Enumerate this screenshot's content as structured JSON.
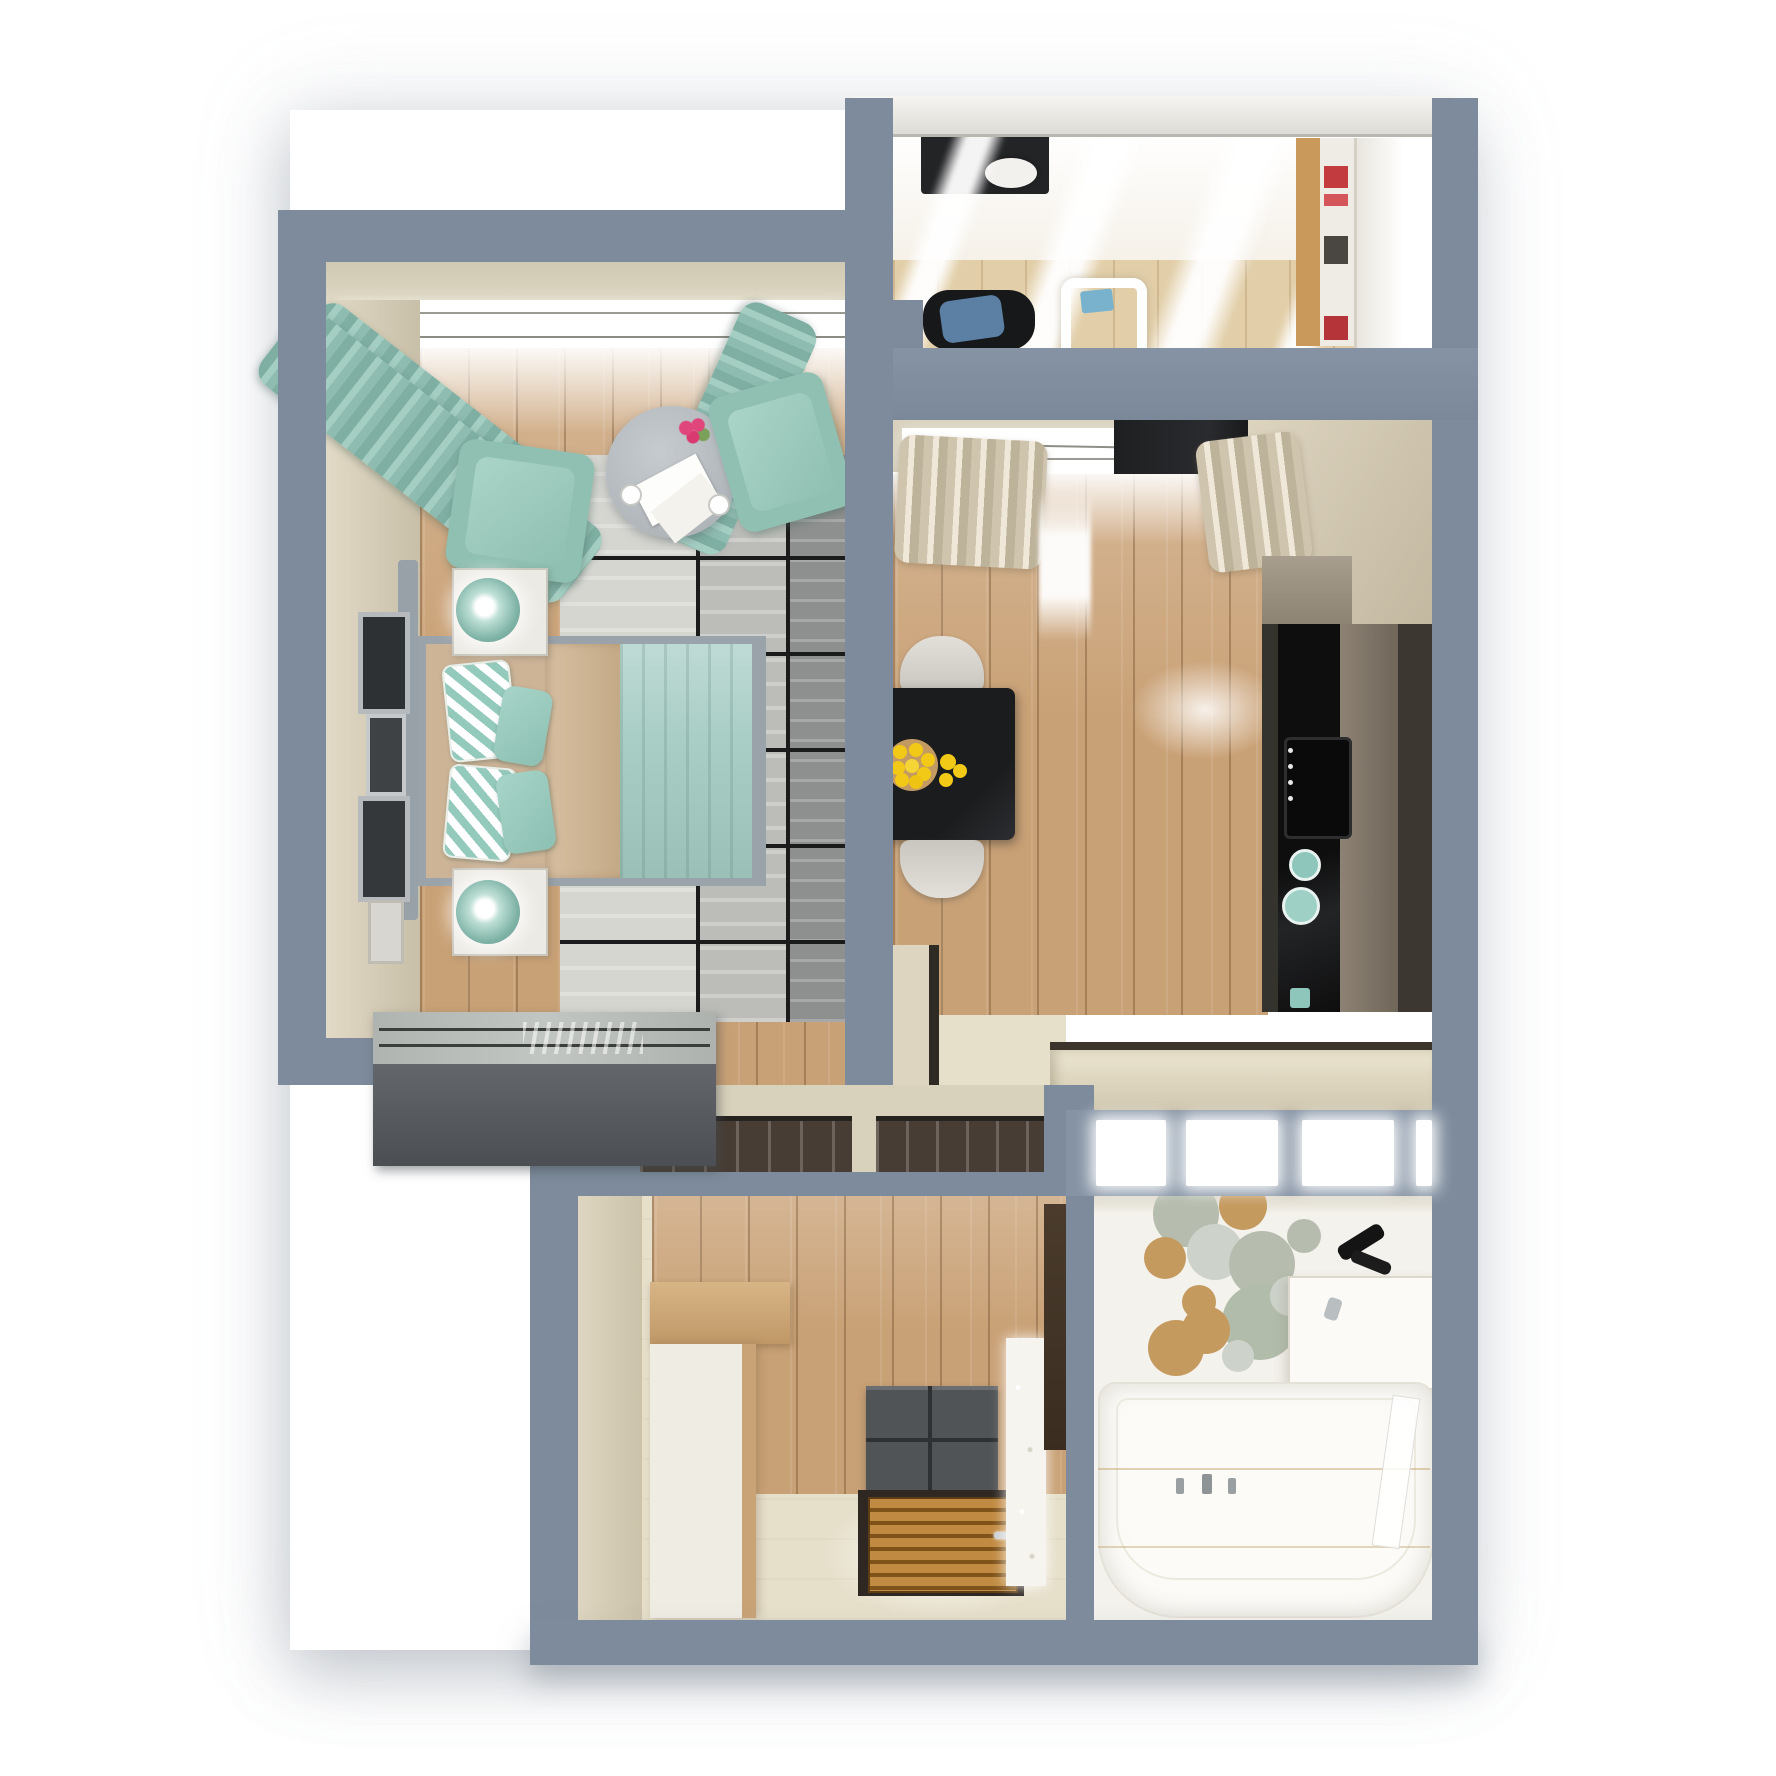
{
  "meta": {
    "title": "3D top-down floor plan render of a one-bedroom apartment",
    "style": "photorealistic architectural visualization, no on-screen text"
  },
  "palette": {
    "wall": "#7d8b9c",
    "wallLight": "#8593a4",
    "roof": "#e9e8e4",
    "beige": "#d9d1bc",
    "cream": "#e6dfca",
    "wood": "#c9a176",
    "teal": "#8fbcb0",
    "tealLight": "#a9d2c7",
    "duvet": "#cdb497",
    "bedframe": "#9aa2aa",
    "black": "#17181a",
    "charcoal": "#515456",
    "mat": "#473d34",
    "doorwood": "#b87d36",
    "lemon": "#f2c917",
    "rugDark": "#8e908f",
    "sage": "#b6bdae",
    "tan": "#c59a5f",
    "stone": "#cdd2ca",
    "blue": "#5b80a4",
    "red": "#c23b3f"
  },
  "rooms": {
    "bedroom": {
      "label": "bedroom",
      "furniture": [
        "double bed",
        "two nightstands with teal lamps",
        "two teal armchairs",
        "round coffee table with flowers",
        "teal curtains",
        "gray grid rug",
        "dark gray wardrobe",
        "wall frames"
      ]
    },
    "kitchen": {
      "label": "kitchen-living room",
      "furniture": [
        "black dining table",
        "bowl of lemons",
        "two gray chairs",
        "beige curtains",
        "dark kitchen units",
        "black cooktop",
        "teal dishes",
        "bottom counter"
      ]
    },
    "balcony": {
      "label": "balcony office",
      "furniture": [
        "dark desk",
        "office chair with blue cushion",
        "white chair",
        "shelving with red books",
        "white wardrobe"
      ]
    },
    "hallway": {
      "label": "hallway",
      "furniture": [
        "wood-top sideboard",
        "charcoal shoe dresser",
        "entrance door (top view)",
        "sparkling curtain strip",
        "dark wall panel"
      ]
    },
    "bathroom": {
      "label": "bathroom",
      "furniture": [
        "bathtub with faucets",
        "washbasin counter",
        "black shower fixture",
        "circle wall decor"
      ]
    }
  },
  "bathroom_decor_circles": [
    {
      "x": 1186,
      "y": 1214,
      "r": 33,
      "c": "#b6bdae"
    },
    {
      "x": 1243,
      "y": 1206,
      "r": 24,
      "c": "#c59a5f"
    },
    {
      "x": 1165,
      "y": 1258,
      "r": 21,
      "c": "#c59a5f"
    },
    {
      "x": 1215,
      "y": 1252,
      "r": 28,
      "c": "#cdd2ca"
    },
    {
      "x": 1262,
      "y": 1264,
      "r": 33,
      "c": "#b6bdae"
    },
    {
      "x": 1199,
      "y": 1302,
      "r": 17,
      "c": "#c59a5f"
    },
    {
      "x": 1260,
      "y": 1322,
      "r": 38,
      "c": "#b2bcab"
    },
    {
      "x": 1206,
      "y": 1330,
      "r": 24,
      "c": "#c59a5f"
    },
    {
      "x": 1176,
      "y": 1348,
      "r": 28,
      "c": "#c59a5f"
    },
    {
      "x": 1290,
      "y": 1296,
      "r": 20,
      "c": "#cdd2ca"
    },
    {
      "x": 1304,
      "y": 1236,
      "r": 17,
      "c": "#b6bdae"
    },
    {
      "x": 1238,
      "y": 1356,
      "r": 16,
      "c": "#cdd2ca"
    }
  ],
  "lemon_dots": [
    {
      "x": 912,
      "y": 765,
      "r": 26,
      "c": "#c39a62"
    },
    {
      "x": 900,
      "y": 752,
      "r": 7,
      "c": "#f2c917"
    },
    {
      "x": 916,
      "y": 750,
      "r": 7,
      "c": "#f2c917"
    },
    {
      "x": 928,
      "y": 760,
      "r": 7,
      "c": "#f2c917"
    },
    {
      "x": 898,
      "y": 768,
      "r": 7,
      "c": "#f2c917"
    },
    {
      "x": 912,
      "y": 766,
      "r": 7,
      "c": "#f5d435"
    },
    {
      "x": 924,
      "y": 774,
      "r": 7,
      "c": "#f2c917"
    },
    {
      "x": 902,
      "y": 780,
      "r": 7,
      "c": "#f2c917"
    },
    {
      "x": 916,
      "y": 782,
      "r": 7,
      "c": "#eec312"
    },
    {
      "x": 948,
      "y": 762,
      "r": 8,
      "c": "#f2c917"
    },
    {
      "x": 960,
      "y": 771,
      "r": 7,
      "c": "#f2c917"
    },
    {
      "x": 946,
      "y": 780,
      "r": 7,
      "c": "#f2c917"
    },
    {
      "x": 893,
      "y": 769,
      "r": 5,
      "c": "#f2c917"
    }
  ],
  "glazing_windows": [
    {
      "x": 1096,
      "y": 1120,
      "w": 70,
      "h": 66
    },
    {
      "x": 1186,
      "y": 1120,
      "w": 92,
      "h": 66
    },
    {
      "x": 1302,
      "y": 1120,
      "w": 92,
      "h": 66
    },
    {
      "x": 1416,
      "y": 1120,
      "w": 16,
      "h": 66
    }
  ]
}
